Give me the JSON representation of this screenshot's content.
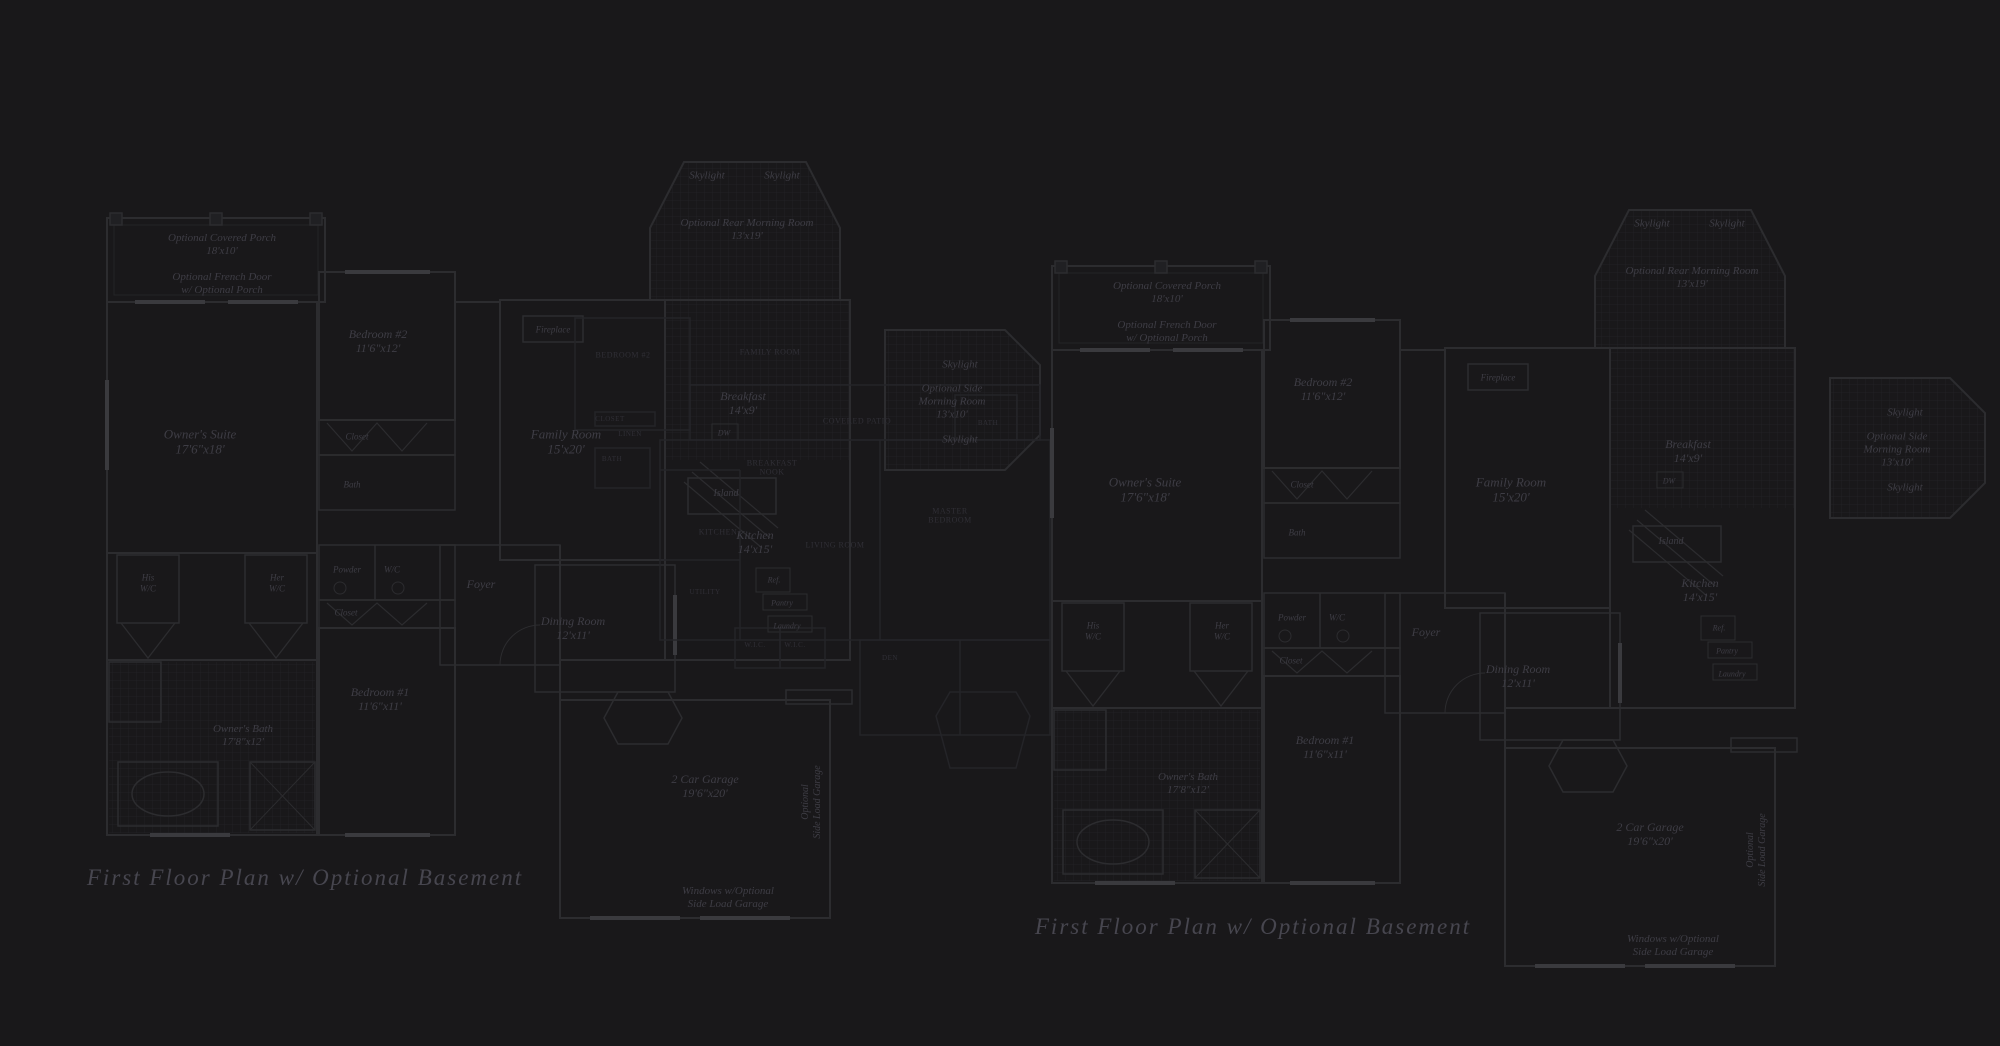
{
  "canvas": {
    "width": 2000,
    "height": 1046,
    "background": "#19181a",
    "wall_color": "#2c2c2f",
    "window_color": "#3a3a3e",
    "tile_color": "#212124",
    "overlay_color": "#242428",
    "label_color": "#3e3d45",
    "title_color": "#47464f"
  },
  "plans": [
    {
      "id": "left",
      "title": "First Floor Plan  w/ Optional Basement",
      "title_x": 305,
      "title_y": 878,
      "dx": 0,
      "dy": 0,
      "overlay": true
    },
    {
      "id": "right",
      "title": "First Floor Plan  w/ Optional Basement",
      "title_x": 1253,
      "title_y": 927,
      "dx": 945,
      "dy": 48,
      "overlay": false
    }
  ],
  "room_labels": [
    {
      "lines": [
        "Optional Covered Porch",
        "18'x10'"
      ],
      "x": 222,
      "y": 245,
      "fs": 11
    },
    {
      "lines": [
        "Optional French Door",
        "w/ Optional Porch"
      ],
      "x": 222,
      "y": 284,
      "fs": 11
    },
    {
      "lines": [
        "Owner's Suite",
        "17'6\"x18'"
      ],
      "x": 200,
      "y": 442,
      "fs": 13
    },
    {
      "lines": [
        "Bedroom #2",
        "11'6\"x12'"
      ],
      "x": 378,
      "y": 341,
      "fs": 12
    },
    {
      "lines": [
        "Closet"
      ],
      "x": 357,
      "y": 437,
      "fs": 9
    },
    {
      "lines": [
        "Bath"
      ],
      "x": 352,
      "y": 485,
      "fs": 9
    },
    {
      "lines": [
        "Fireplace"
      ],
      "x": 553,
      "y": 330,
      "fs": 9
    },
    {
      "lines": [
        "Family Room",
        "15'x20'"
      ],
      "x": 566,
      "y": 442,
      "fs": 13
    },
    {
      "lines": [
        "Skylight"
      ],
      "x": 707,
      "y": 176,
      "fs": 11
    },
    {
      "lines": [
        "Skylight"
      ],
      "x": 782,
      "y": 176,
      "fs": 11
    },
    {
      "lines": [
        "Optional Rear Morning Room",
        "13'x19'"
      ],
      "x": 747,
      "y": 230,
      "fs": 11
    },
    {
      "lines": [
        "Skylight"
      ],
      "x": 960,
      "y": 365,
      "fs": 11
    },
    {
      "lines": [
        "Optional Side",
        "Morning Room",
        "13'x10'"
      ],
      "x": 952,
      "y": 402,
      "fs": 11
    },
    {
      "lines": [
        "Skylight"
      ],
      "x": 960,
      "y": 440,
      "fs": 11
    },
    {
      "lines": [
        "Breakfast",
        "14'x9'"
      ],
      "x": 743,
      "y": 403,
      "fs": 12
    },
    {
      "lines": [
        "DW"
      ],
      "x": 724,
      "y": 433,
      "fs": 8
    },
    {
      "lines": [
        "Island"
      ],
      "x": 726,
      "y": 494,
      "fs": 10
    },
    {
      "lines": [
        "Kitchen",
        "14'x15'"
      ],
      "x": 755,
      "y": 542,
      "fs": 12
    },
    {
      "lines": [
        "Ref."
      ],
      "x": 774,
      "y": 580,
      "fs": 8
    },
    {
      "lines": [
        "Pantry"
      ],
      "x": 782,
      "y": 603,
      "fs": 8
    },
    {
      "lines": [
        "Laundry"
      ],
      "x": 787,
      "y": 626,
      "fs": 8
    },
    {
      "lines": [
        "His",
        "W/C"
      ],
      "x": 148,
      "y": 583,
      "fs": 9
    },
    {
      "lines": [
        "Her",
        "W/C"
      ],
      "x": 277,
      "y": 583,
      "fs": 9
    },
    {
      "lines": [
        "Powder"
      ],
      "x": 347,
      "y": 570,
      "fs": 9
    },
    {
      "lines": [
        "W/C"
      ],
      "x": 392,
      "y": 570,
      "fs": 9
    },
    {
      "lines": [
        "Closet"
      ],
      "x": 346,
      "y": 613,
      "fs": 9
    },
    {
      "lines": [
        "Foyer"
      ],
      "x": 481,
      "y": 584,
      "fs": 12
    },
    {
      "lines": [
        "Dining Room",
        "12'x11'"
      ],
      "x": 573,
      "y": 628,
      "fs": 12
    },
    {
      "lines": [
        "Bedroom #1",
        "11'6\"x11'"
      ],
      "x": 380,
      "y": 699,
      "fs": 12
    },
    {
      "lines": [
        "Owner's Bath",
        "17'8\"x12'"
      ],
      "x": 243,
      "y": 736,
      "fs": 11
    },
    {
      "lines": [
        "2 Car Garage",
        "19'6\"x20'"
      ],
      "x": 705,
      "y": 786,
      "fs": 12
    },
    {
      "lines": [
        "Optional",
        "Side Load Garage"
      ],
      "x": 812,
      "y": 802,
      "fs": 10,
      "rot": -90
    },
    {
      "lines": [
        "Windows w/Optional",
        "Side Load Garage"
      ],
      "x": 728,
      "y": 898,
      "fs": 11
    }
  ],
  "overlay_labels": [
    {
      "lines": [
        "BEDROOM #2"
      ],
      "x": 623,
      "y": 355,
      "fs": 8
    },
    {
      "lines": [
        "FAMILY ROOM"
      ],
      "x": 770,
      "y": 352,
      "fs": 8
    },
    {
      "lines": [
        "CLOSET"
      ],
      "x": 610,
      "y": 419,
      "fs": 7
    },
    {
      "lines": [
        "LINEN"
      ],
      "x": 630,
      "y": 434,
      "fs": 7
    },
    {
      "lines": [
        "BATH"
      ],
      "x": 612,
      "y": 459,
      "fs": 7
    },
    {
      "lines": [
        "COVERED PATIO"
      ],
      "x": 857,
      "y": 421,
      "fs": 8
    },
    {
      "lines": [
        "BATH"
      ],
      "x": 988,
      "y": 423,
      "fs": 7
    },
    {
      "lines": [
        "BREAKFAST",
        "NOOK"
      ],
      "x": 772,
      "y": 468,
      "fs": 8
    },
    {
      "lines": [
        "KITCHEN"
      ],
      "x": 718,
      "y": 532,
      "fs": 8
    },
    {
      "lines": [
        "LIVING ROOM"
      ],
      "x": 835,
      "y": 545,
      "fs": 8
    },
    {
      "lines": [
        "MASTER",
        "BEDROOM"
      ],
      "x": 950,
      "y": 516,
      "fs": 8
    },
    {
      "lines": [
        "UTILITY"
      ],
      "x": 705,
      "y": 592,
      "fs": 7
    },
    {
      "lines": [
        "W.I.C."
      ],
      "x": 755,
      "y": 645,
      "fs": 7
    },
    {
      "lines": [
        "W.I.C."
      ],
      "x": 795,
      "y": 645,
      "fs": 7
    },
    {
      "lines": [
        "DEN"
      ],
      "x": 890,
      "y": 658,
      "fs": 7
    }
  ]
}
